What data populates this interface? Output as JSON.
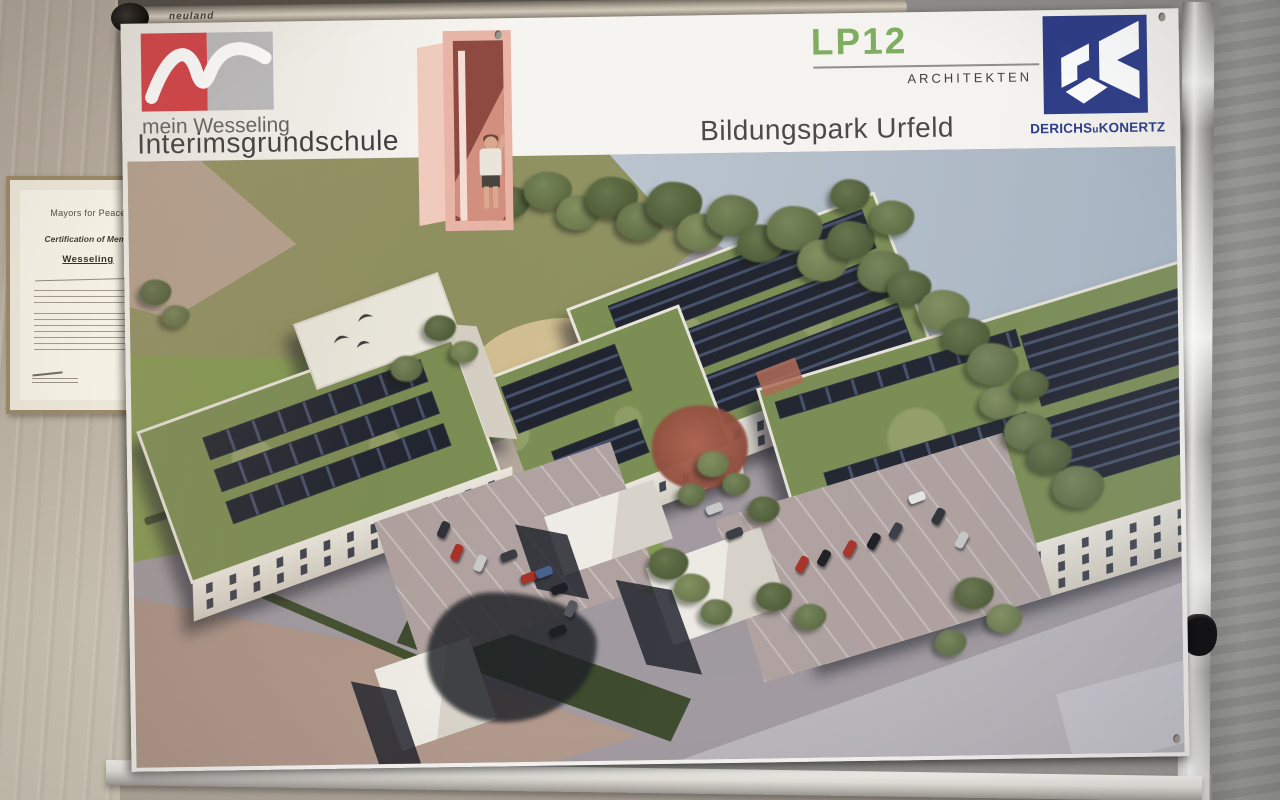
{
  "board": {
    "brand": "neuland"
  },
  "poster": {
    "logo_caption": "mein Wesseling",
    "title_left": "Interimsgrundschule",
    "title_center": "Bildungspark Urfeld",
    "architect": {
      "name": "LP12",
      "label": "ARCHITEKTEN"
    },
    "contractor": {
      "name_parts": [
        "DERICHS",
        "u",
        "KONERTZ"
      ]
    },
    "colors": {
      "lp12_green": "#7fae60",
      "dk_navy": "#2d3c87",
      "wesseling_red": "#d23c41",
      "wesseling_gray": "#b9b9bb"
    }
  },
  "certificate": {
    "org": "Mayors for Peace",
    "line1": "Certification of Memb",
    "city": "Wesseling"
  },
  "rendering": {
    "trees": [
      {
        "x": 330,
        "y": 8,
        "r": 26,
        "v": 1
      },
      {
        "x": 362,
        "y": 30,
        "r": 20,
        "v": 2
      },
      {
        "x": 396,
        "y": 16,
        "r": 24,
        "v": 1
      },
      {
        "x": 428,
        "y": 40,
        "r": 22,
        "v": 3
      },
      {
        "x": 458,
        "y": 22,
        "r": 26,
        "v": 2
      },
      {
        "x": 488,
        "y": 48,
        "r": 24,
        "v": 1
      },
      {
        "x": 518,
        "y": 28,
        "r": 28,
        "v": 2
      },
      {
        "x": 548,
        "y": 60,
        "r": 24,
        "v": 3
      },
      {
        "x": 578,
        "y": 42,
        "r": 26,
        "v": 1
      },
      {
        "x": 608,
        "y": 72,
        "r": 24,
        "v": 2
      },
      {
        "x": 638,
        "y": 54,
        "r": 28,
        "v": 1
      },
      {
        "x": 668,
        "y": 88,
        "r": 26,
        "v": 3
      },
      {
        "x": 698,
        "y": 70,
        "r": 24,
        "v": 2
      },
      {
        "x": 728,
        "y": 100,
        "r": 26,
        "v": 1
      },
      {
        "x": 758,
        "y": 120,
        "r": 22,
        "v": 2
      },
      {
        "x": 788,
        "y": 140,
        "r": 26,
        "v": 3
      },
      {
        "x": 702,
        "y": 28,
        "r": 20,
        "v": 2
      },
      {
        "x": 742,
        "y": 50,
        "r": 22,
        "v": 1
      },
      {
        "x": 812,
        "y": 168,
        "r": 24,
        "v": 2
      },
      {
        "x": 836,
        "y": 194,
        "r": 26,
        "v": 1
      },
      {
        "x": 848,
        "y": 238,
        "r": 20,
        "v": 3
      },
      {
        "x": 872,
        "y": 264,
        "r": 24,
        "v": 1
      },
      {
        "x": 896,
        "y": 290,
        "r": 22,
        "v": 2
      },
      {
        "x": 920,
        "y": 318,
        "r": 26,
        "v": 1
      },
      {
        "x": 882,
        "y": 222,
        "r": 18,
        "v": 2
      },
      {
        "x": 565,
        "y": 298,
        "r": 16,
        "v": 3
      },
      {
        "x": 590,
        "y": 320,
        "r": 14,
        "v": 1
      },
      {
        "x": 615,
        "y": 344,
        "r": 16,
        "v": 2
      },
      {
        "x": 545,
        "y": 330,
        "r": 14,
        "v": 1
      },
      {
        "x": 515,
        "y": 394,
        "r": 20,
        "v": 2
      },
      {
        "x": 540,
        "y": 420,
        "r": 18,
        "v": 3
      },
      {
        "x": 566,
        "y": 446,
        "r": 16,
        "v": 1
      },
      {
        "x": 622,
        "y": 430,
        "r": 18,
        "v": 2
      },
      {
        "x": 660,
        "y": 452,
        "r": 16,
        "v": 1
      },
      {
        "x": 820,
        "y": 428,
        "r": 20,
        "v": 2
      },
      {
        "x": 852,
        "y": 455,
        "r": 18,
        "v": 3
      },
      {
        "x": 800,
        "y": 480,
        "r": 16,
        "v": 1
      },
      {
        "x": 10,
        "y": 118,
        "r": 16,
        "v": 2
      },
      {
        "x": 32,
        "y": 144,
        "r": 14,
        "v": 1
      },
      {
        "x": 294,
        "y": 158,
        "r": 16,
        "v": 2
      },
      {
        "x": 320,
        "y": 184,
        "r": 14,
        "v": 3
      },
      {
        "x": 260,
        "y": 198,
        "r": 16,
        "v": 1
      }
    ],
    "cars": [
      {
        "x": 315,
        "y": 391,
        "c": "#a83228",
        "a": -65
      },
      {
        "x": 338,
        "y": 402,
        "c": "#c9c9c9",
        "a": -65
      },
      {
        "x": 367,
        "y": 395,
        "c": "#3a3d44",
        "a": -20
      },
      {
        "x": 387,
        "y": 417,
        "c": "#a83228",
        "a": -20
      },
      {
        "x": 402,
        "y": 412,
        "c": "#49618f",
        "a": -20
      },
      {
        "x": 417,
        "y": 429,
        "c": "#1c1e22",
        "a": -20
      },
      {
        "x": 428,
        "y": 449,
        "c": "#55585f",
        "a": -65
      },
      {
        "x": 415,
        "y": 471,
        "c": "#1c1e22",
        "a": -20
      },
      {
        "x": 302,
        "y": 368,
        "c": "#2e3138",
        "a": -65
      },
      {
        "x": 573,
        "y": 351,
        "c": "#c9c9c9",
        "a": -20
      },
      {
        "x": 593,
        "y": 376,
        "c": "#3a3d44",
        "a": -20
      },
      {
        "x": 660,
        "y": 408,
        "c": "#a83228",
        "a": -60
      },
      {
        "x": 682,
        "y": 402,
        "c": "#1c1e22",
        "a": -60
      },
      {
        "x": 708,
        "y": 393,
        "c": "#a83228",
        "a": -60
      },
      {
        "x": 732,
        "y": 386,
        "c": "#1c1e22",
        "a": -60
      },
      {
        "x": 754,
        "y": 376,
        "c": "#3a3d44",
        "a": -60
      },
      {
        "x": 776,
        "y": 343,
        "c": "#e8e8e8",
        "a": -20
      },
      {
        "x": 797,
        "y": 362,
        "c": "#2e3138",
        "a": -60
      },
      {
        "x": 820,
        "y": 386,
        "c": "#c9c9c9",
        "a": -60
      }
    ]
  }
}
